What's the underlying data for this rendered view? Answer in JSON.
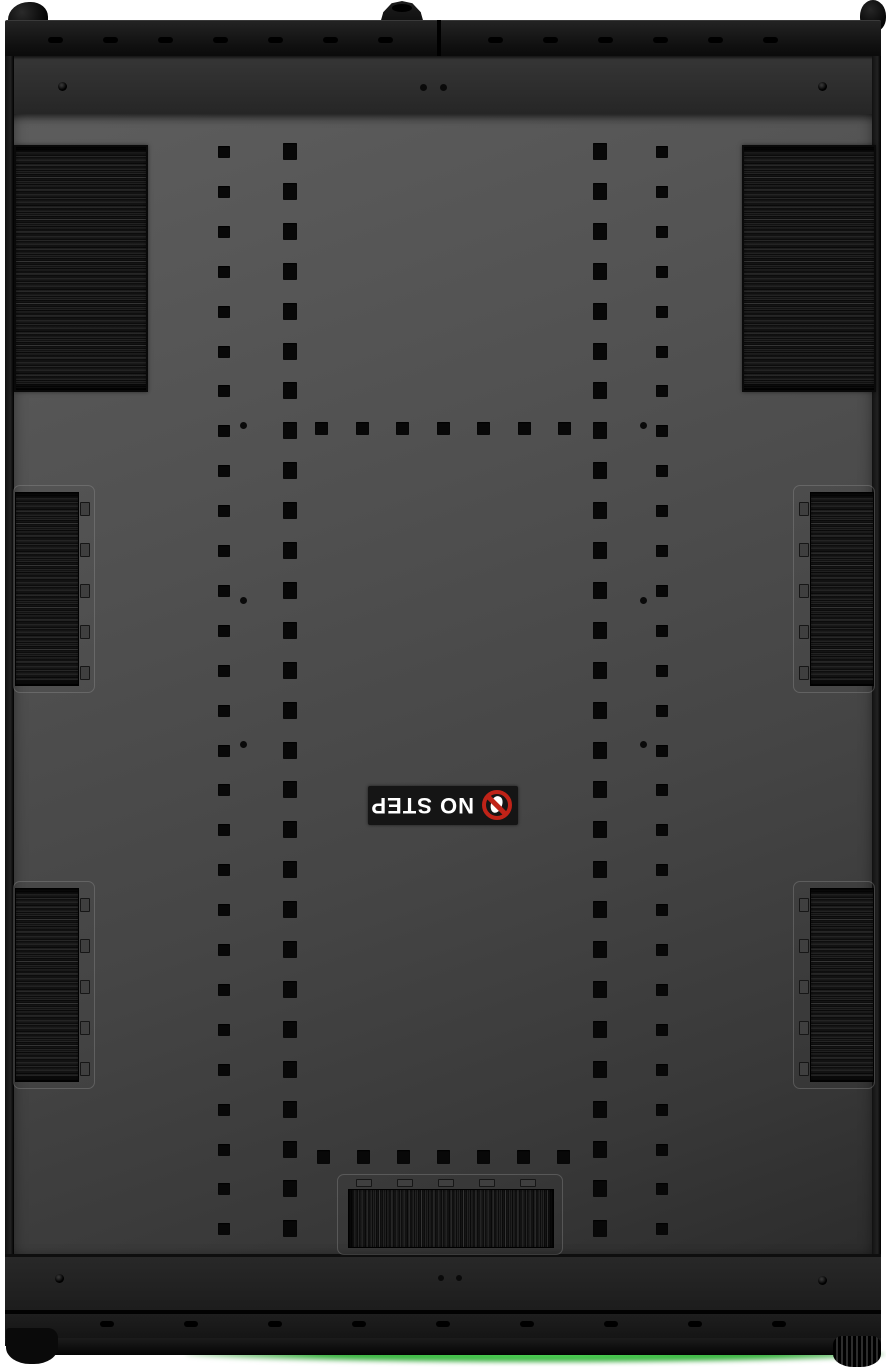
{
  "label": {
    "text": "NO STEP",
    "background": "#151515",
    "text_color": "#ffffff",
    "prohibition_color": "#c02318",
    "icon": "no-step-prohibition-icon",
    "rotation_deg": 180
  },
  "colors": {
    "page_background": "#ffffff",
    "panel_top": "#5d5d5d",
    "panel_bottom": "#2c2c2c",
    "frame_dark": "#121212",
    "hole": "#080808",
    "underglow_green": "#3fbf45"
  },
  "pattern": {
    "top_slots": {
      "x0": 48,
      "step": 55,
      "count": 14,
      "skip": 7,
      "y": 37,
      "w": 15,
      "h": 6
    },
    "bottom_slots": {
      "x0": 100,
      "step": 84,
      "count": 9,
      "y": 1321,
      "w": 14,
      "h": 6
    },
    "hole_columns": [
      {
        "x": 218,
        "w": 12,
        "h": 12,
        "y0": 146,
        "step": 39.9,
        "count": 28
      },
      {
        "x": 283,
        "w": 14,
        "h": 17,
        "y0": 143,
        "step": 39.9,
        "count": 28
      },
      {
        "x": 593,
        "w": 14,
        "h": 17,
        "y0": 143,
        "step": 39.9,
        "count": 28
      },
      {
        "x": 656,
        "w": 12,
        "h": 12,
        "y0": 146,
        "step": 39.9,
        "count": 28
      }
    ],
    "hole_rows": [
      {
        "y": 422,
        "x0": 315,
        "step": 40.5,
        "count": 7,
        "w": 13,
        "h": 13
      },
      {
        "y": 1150,
        "x0": 317,
        "step": 40,
        "count": 7,
        "w": 13,
        "h": 14
      }
    ],
    "pilot_dots": {
      "d": 7,
      "points": [
        [
          240,
          422
        ],
        [
          640,
          422
        ],
        [
          240,
          597
        ],
        [
          640,
          597
        ],
        [
          240,
          741
        ],
        [
          640,
          741
        ]
      ]
    },
    "top_center_dots": {
      "d": 7,
      "points": [
        [
          420,
          84
        ],
        [
          440,
          84
        ]
      ]
    },
    "bottom_center_dots": {
      "d": 6,
      "points": [
        [
          438,
          1275
        ],
        [
          456,
          1275
        ]
      ]
    },
    "round_holes": {
      "d": 9,
      "points": [
        [
          58,
          82
        ],
        [
          818,
          82
        ],
        [
          55,
          1274
        ],
        [
          818,
          1276
        ]
      ]
    },
    "corner_brushes": [
      {
        "x": 14,
        "y": 145,
        "w": 130,
        "h": 243
      },
      {
        "x": 742,
        "y": 145,
        "w": 130,
        "h": 243
      }
    ],
    "side_brushes": [
      {
        "x": 13,
        "y": 485,
        "side": "left"
      },
      {
        "x": 13,
        "y": 881,
        "side": "left"
      },
      {
        "x": 793,
        "y": 485,
        "side": "right"
      },
      {
        "x": 793,
        "y": 881,
        "side": "right"
      }
    ],
    "side_brush_size": {
      "w": 80,
      "h": 206,
      "clips": 5
    },
    "bottom_brush": {
      "x": 337,
      "y": 1174,
      "w": 224,
      "h": 79,
      "clips": 5
    }
  }
}
